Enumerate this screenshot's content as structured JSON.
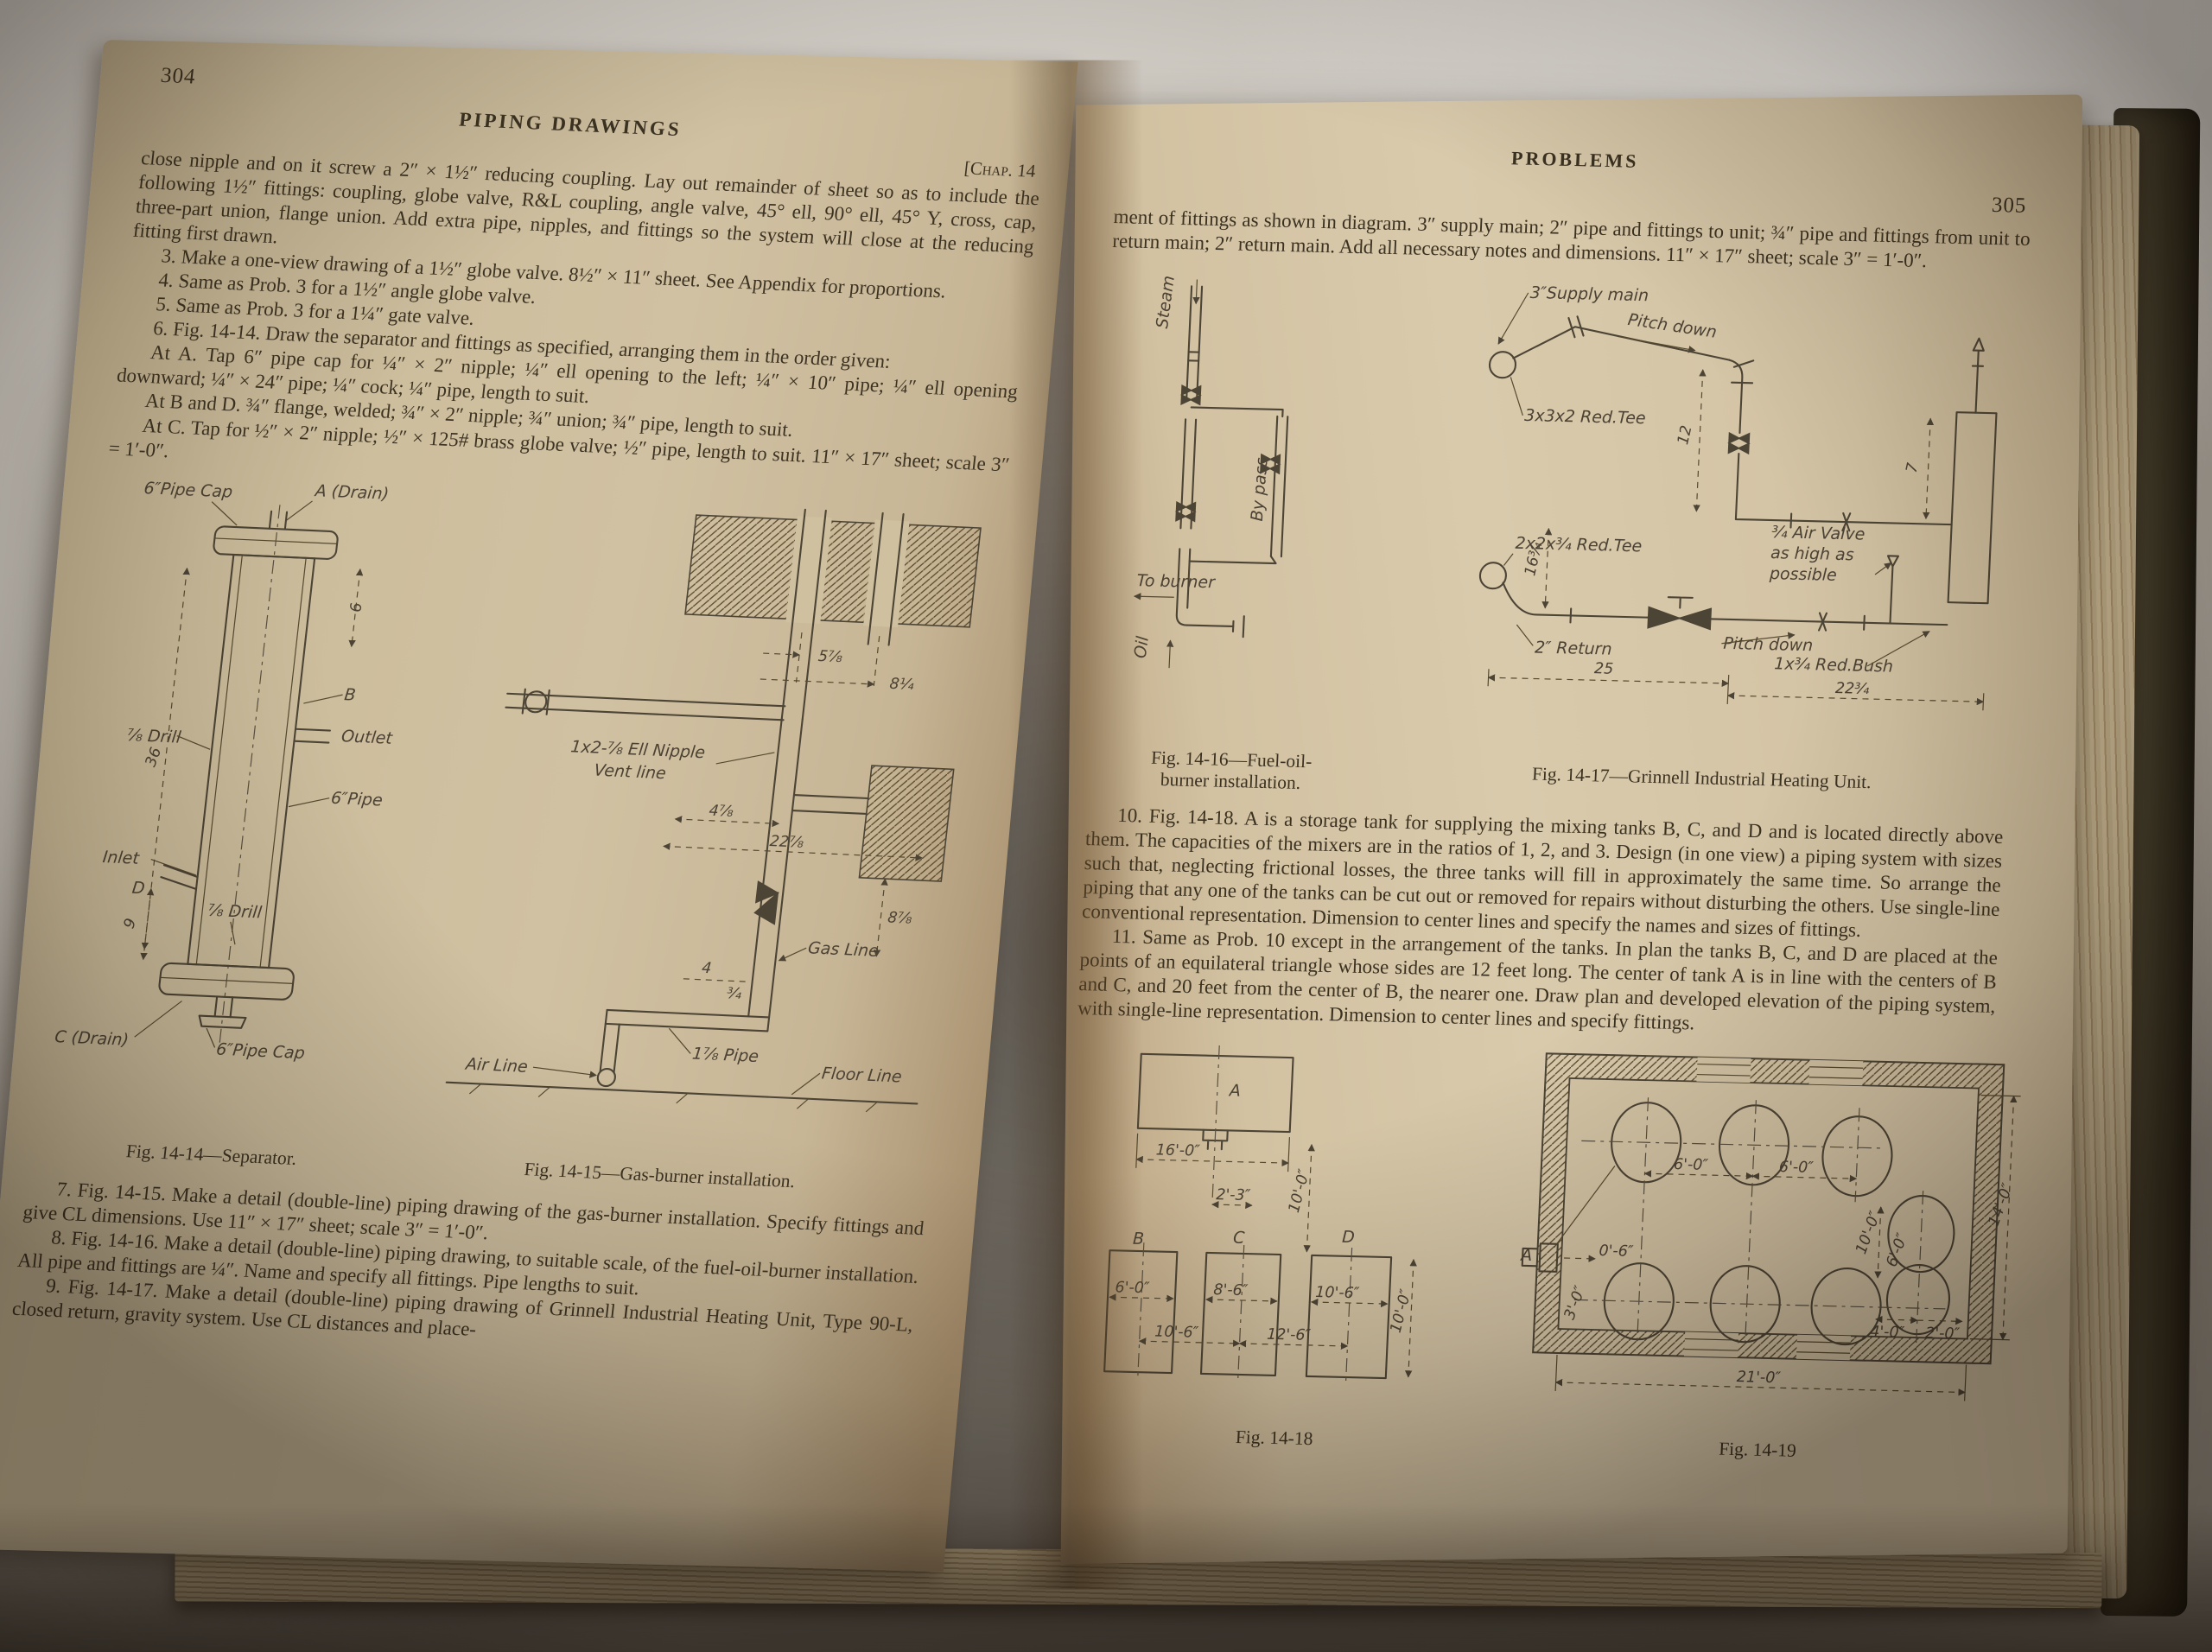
{
  "colors": {
    "page": "#cfc0a0",
    "ink": "#3c3322",
    "cover": "#3d3827"
  },
  "left_page": {
    "page_number": "304",
    "running_head": "PIPING DRAWINGS",
    "chapter_ref": "[Chap. 14",
    "intro": "close nipple and on it screw a 2″ × 1½″ reducing coupling.  Lay out remainder of sheet so as to include the following 1½″ fittings: coupling, globe valve, R&L coupling, angle valve, 45° ell, 90° ell, 45° Y, cross, cap, three-part union, flange union.  Add extra pipe, nipples, and fittings so the system will close at the reducing fitting first drawn.",
    "prob3": "3.  Make a one-view drawing of a 1½″ globe valve.  8½″ × 11″ sheet.  See Appendix for proportions.",
    "prob4": "4.  Same as Prob. 3 for a 1½″ angle globe valve.",
    "prob5": "5.  Same as Prob. 3 for a 1¼″ gate valve.",
    "prob6": "6.  Fig. 14-14.  Draw the separator and fittings as specified, arranging them in the order given:",
    "at_a": "At A.  Tap 6″ pipe cap for ¼″ × 2″ nipple; ¼″ ell opening to the left; ¼″ × 10″ pipe; ¼″ ell opening downward; ¼″ × 24″ pipe; ¼″ cock; ¼″ pipe, length to suit.",
    "at_bd": "At B and D.  ¾″ flange, welded; ¾″ × 2″ nipple; ¾″ union; ¾″ pipe, length to suit.",
    "at_c": "At C.  Tap for ½″ × 2″ nipple; ½″ × 125# brass globe valve; ½″ pipe, length to suit.  11″ × 17″ sheet; scale 3″ = 1′-0″.",
    "caption_1414": "Fig. 14-14—Separator.",
    "caption_1415": "Fig. 14-15—Gas-burner installation.",
    "prob7": "7.  Fig. 14-15.  Make a detail (double-line) piping drawing of the gas-burner installation.  Specify fittings and give CL dimensions.  Use 11″ × 17″ sheet; scale 3″ = 1′-0″.",
    "prob8": "8.  Fig. 14-16.  Make a detail (double-line) piping drawing, to suitable scale, of the fuel-oil-burner installation.  All pipe and fittings are ¼″.  Name and specify all fittings.  Pipe lengths to suit.",
    "prob9": "9.  Fig. 14-17.  Make a detail (double-line) piping drawing of Grinnell Industrial Heating Unit, Type 90-L, closed return, gravity system.  Use CL distances and place-"
  },
  "right_page": {
    "running_head": "PROBLEMS",
    "page_number": "305",
    "intro": "ment of fittings as shown in diagram.  3″ supply main; 2″ pipe and fittings to unit; ¾″ pipe and fittings from unit to return main; 2″ return main.  Add all necessary notes and dimensions.  11″ × 17″ sheet; scale 3″ = 1′-0″.",
    "caption_1416_line1": "Fig. 14-16—Fuel-oil-",
    "caption_1416_line2": "burner installation.",
    "caption_1417": "Fig. 14-17—Grinnell Industrial Heating Unit.",
    "prob10": "10.  Fig. 14-18.  A is a storage tank for supplying the mixing tanks B, C, and D and is located directly above them.  The capacities of the mixers are in the ratios of 1, 2, and 3.  Design (in one view) a piping system with sizes such that, neglecting frictional losses, the three tanks will fill in approximately the same time.  So arrange the piping that any one of the tanks can be cut out or removed for repairs without disturbing the others.  Use single-line conventional representation.  Dimension to center lines and specify the names and sizes of fittings.",
    "prob11": "11.  Same as Prob. 10 except in the arrangement of the tanks.  In plan the tanks B, C, and D are placed at the points of an equilateral triangle whose sides are 12 feet long.  The center of tank A is in line with the centers of B and C, and 20 feet from the center of B, the nearer one.  Draw plan and developed elevation of the piping system, with single-line representation.  Dimension to center lines and specify fittings.",
    "caption_1418": "Fig. 14-18",
    "caption_1419": "Fig. 14-19"
  },
  "fig1414": {
    "cap_top": "6″Pipe Cap",
    "drain_top": "A (Drain)",
    "dim6": "6",
    "b": "B",
    "outlet": "Outlet",
    "drill_top": "⅞ Drill",
    "pipe": "6″Pipe",
    "dim36": "36",
    "inlet": "Inlet",
    "d": "D",
    "drill_bot": "⅞ Drill",
    "dim9": "9",
    "drain_bot": "C (Drain)",
    "cap_bot": "6″Pipe Cap"
  },
  "fig1415": {
    "dim1": "5⅞",
    "dim2": "8¼",
    "note1": "1x2-⅞ Ell Nipple",
    "note2": "Vent line",
    "dim3": "4⅞",
    "dim4": "22⅞",
    "dim5": "8⅞",
    "gas": "Gas Line",
    "dim6": "4",
    "dim7": "¾",
    "pipe": "1⅞ Pipe",
    "air": "Air Line",
    "floor": "Floor Line"
  },
  "fig1416": {
    "steam": "Steam",
    "bypass": "By pass",
    "to_burner": "To burner",
    "oil": "Oil"
  },
  "fig1417": {
    "supply": "3″Supply main",
    "pitch1": "Pitch down",
    "tee1": "3x3x2 Red.Tee",
    "dim12": "12",
    "dim7": "7",
    "air1": "¾ Air Valve",
    "air2": "as high as",
    "air3": "possible",
    "tee2": "2x2x¾ Red.Tee",
    "bush": "1x¾ Red.Bush",
    "pitch2": "Pitch down",
    "ret": "2″ Return",
    "dim16": "16¾",
    "dim25": "25",
    "dim22": "22¾"
  },
  "fig1418": {
    "a": "A",
    "w16": "16'-0″",
    "d23": "2'-3″",
    "h10a": "10'-0″",
    "b": "B",
    "c": "C",
    "d": "D",
    "w6": "6'-0″",
    "w86": "8'-6″",
    "w106": "10'-6″",
    "s106": "10'-6″",
    "s126": "12'-6″",
    "h10b": "10'-0″"
  },
  "fig1419": {
    "d60a": "6'-0″",
    "d60b": "6'-0″",
    "d100": "10'-0″",
    "d60c": "6'-0″",
    "a": "A",
    "d06": "0'-6″",
    "d30": "3'-0″",
    "d140": "14'-0″",
    "d40": "4'-0″",
    "d20": "2'-0″",
    "d210": "21'-0″"
  }
}
